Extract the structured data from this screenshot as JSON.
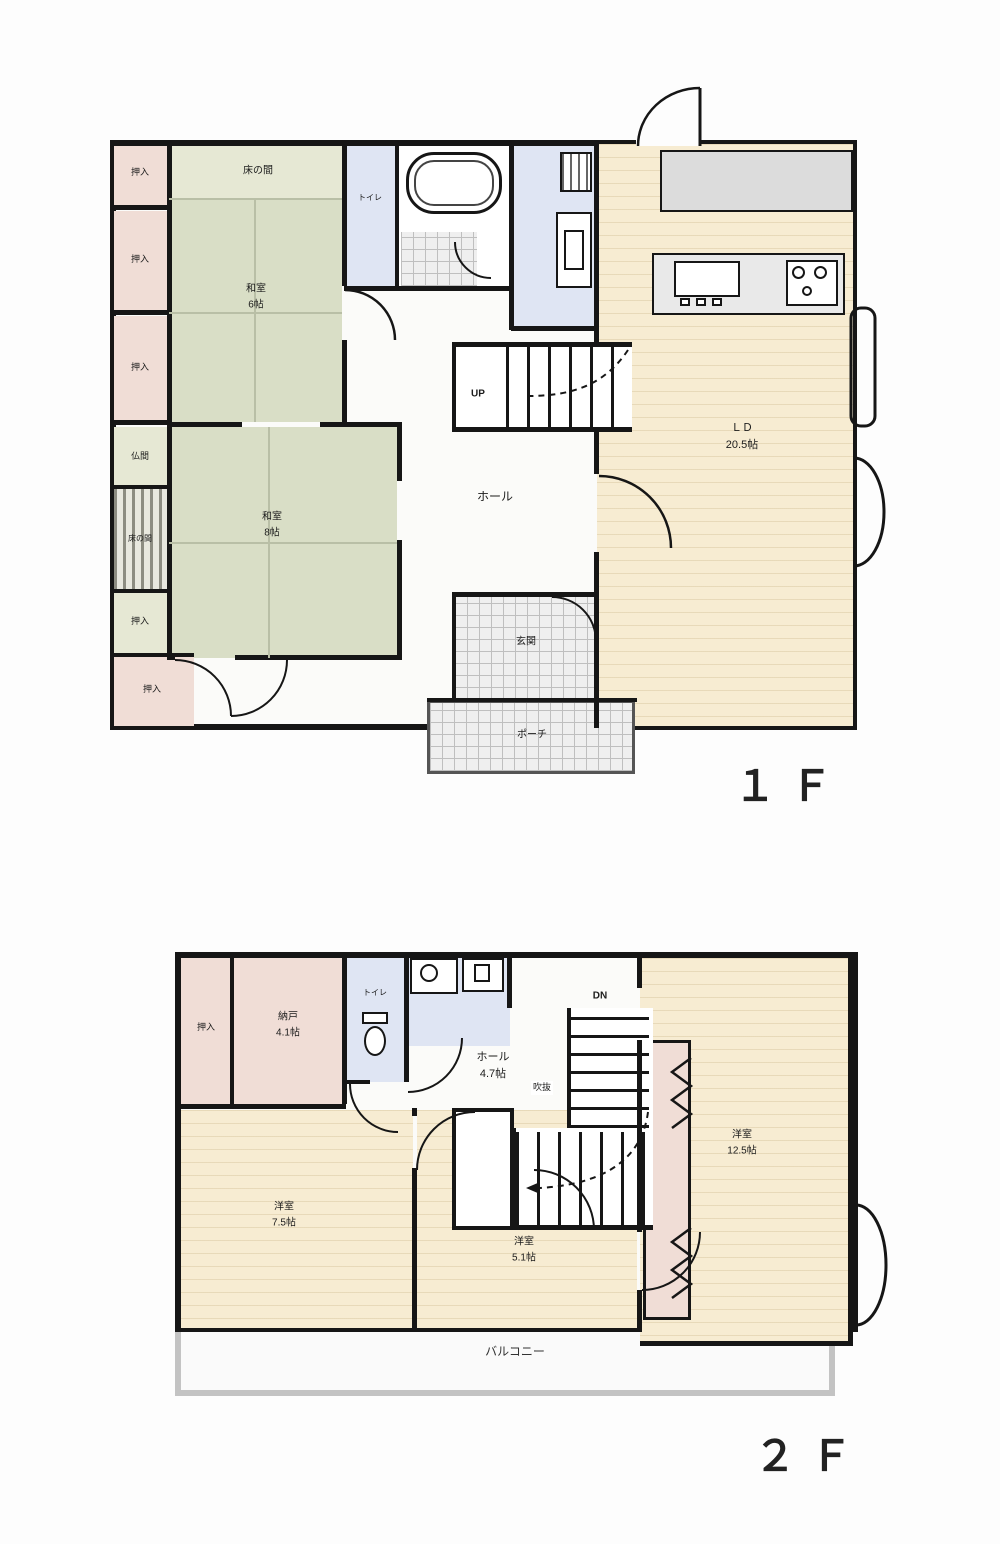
{
  "floor1": {
    "floor_label": "１Ｆ",
    "rooms": {
      "washitsu1": {
        "name": "和室",
        "size": "6帖"
      },
      "washitsu2": {
        "name": "和室",
        "size": "8帖"
      },
      "ld": {
        "name": "ＬＤ",
        "size": "20.5帖"
      },
      "tokonoma": "床の間",
      "butsuma": "仏間",
      "oshiire": "押入",
      "toilet": "トイレ",
      "hall": "ホール",
      "up": "UP",
      "genkan": "玄関",
      "porch": "ポーチ"
    }
  },
  "floor2": {
    "floor_label": "２Ｆ",
    "rooms": {
      "oshiire": "押入",
      "nando": {
        "name": "納戸",
        "size": "4.1帖"
      },
      "toilet": "トイレ",
      "hall": {
        "name": "ホール",
        "size": "4.7帖"
      },
      "dn": "DN",
      "fukinuke": "吹抜",
      "yoshitsu_a": {
        "name": "洋室",
        "size": "7.5帖"
      },
      "yoshitsu_b": {
        "name": "洋室",
        "size": "5.1帖"
      },
      "yoshitsu_c": {
        "name": "洋室",
        "size": "12.5帖"
      },
      "balcony": "バルコニー"
    }
  },
  "colors": {
    "wall": "#161616",
    "tatami": "#d9dec6",
    "wood_floor": "#f7ecd2",
    "closet_pink": "#f0ddd6",
    "wet_blue": "#dfe5f3"
  }
}
